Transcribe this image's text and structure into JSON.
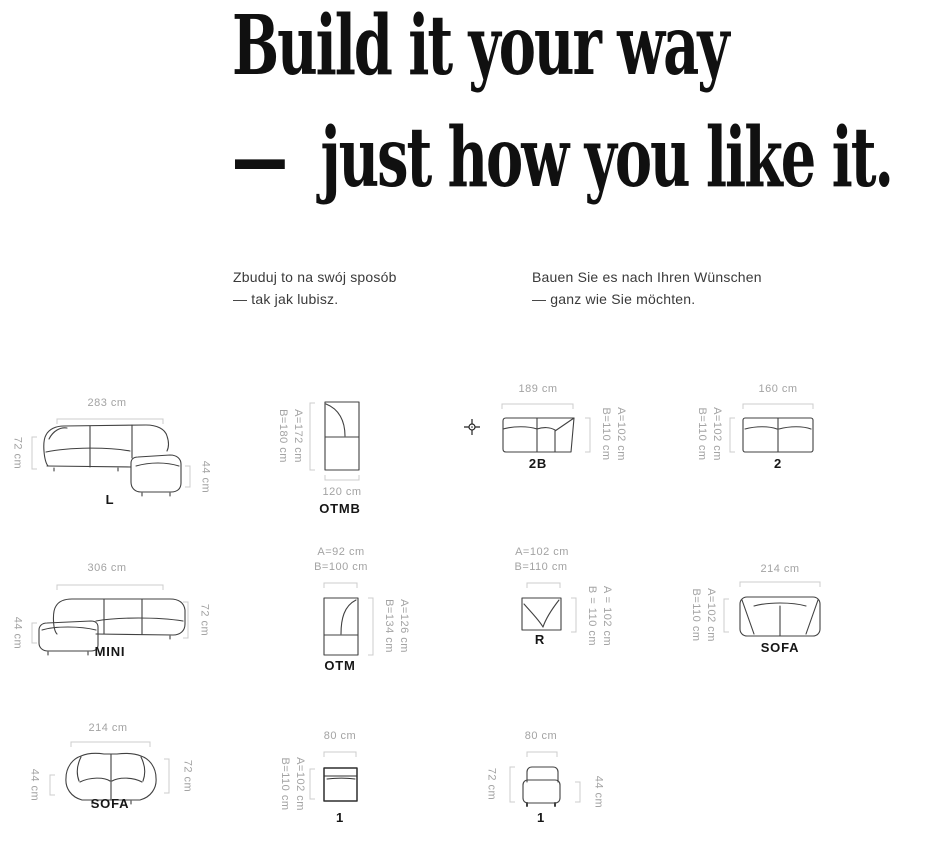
{
  "heading": {
    "line1": "Build it your way",
    "line2": "—  just how you like it."
  },
  "intro": {
    "pl": {
      "line1": "Zbuduj to na swój sposób",
      "line2": "— tak jak lubisz."
    },
    "de": {
      "line1": "Bauen Sie es nach Ihren Wünschen",
      "line2": "— ganz wie Sie möchten."
    }
  },
  "modules": {
    "l": {
      "label": "L",
      "top": "283 cm",
      "left": "72 cm",
      "right": "44 cm"
    },
    "otmb": {
      "label": "OTMB",
      "side_a": "A=172 cm",
      "side_b": "B=180 cm",
      "bottom": "120 cm"
    },
    "two_b": {
      "label": "2B",
      "top": "189 cm",
      "side_a": "A=102 cm",
      "side_b": "B=110 cm"
    },
    "two": {
      "label": "2",
      "top": "160 cm",
      "side_a": "A=102 cm",
      "side_b": "B=110 cm"
    },
    "mini": {
      "label": "MINI",
      "top": "306 cm",
      "left": "44 cm",
      "right": "72 cm"
    },
    "otm": {
      "label": "OTM",
      "top_a": "A=92 cm",
      "top_b": "B=100 cm",
      "side_a": "A=126 cm",
      "side_b": "B=134 cm"
    },
    "r": {
      "label": "R",
      "top_a": "A=102 cm",
      "top_b": "B=110 cm",
      "side_a": "A = 102 cm",
      "side_b": "B = 110 cm"
    },
    "sofa_top": {
      "label": "SOFA",
      "top": "214 cm",
      "side_a": "A=102 cm",
      "side_b": "B=110 cm"
    },
    "sofa_front": {
      "label": "SOFA",
      "top": "214 cm",
      "left": "44 cm",
      "right": "72 cm"
    },
    "one_top": {
      "label": "1",
      "top": "80 cm",
      "side_a": "A=102 cm",
      "side_b": "B=110 cm"
    },
    "one_front": {
      "label": "1",
      "top": "80 cm",
      "left": "72 cm",
      "right": "44 cm"
    }
  },
  "colors": {
    "heading": "#101010",
    "body_text": "#3a3a3a",
    "dim_text": "#a3a3a3",
    "dim_line": "#cccccc",
    "outline": "#414141"
  }
}
